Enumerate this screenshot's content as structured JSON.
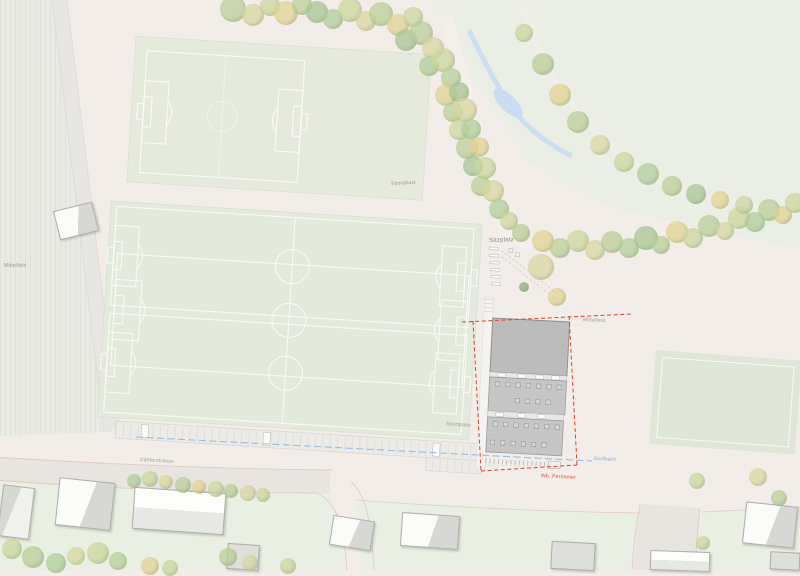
{
  "map": {
    "labels": {
      "sportplatz_top": "Sportplatz",
      "sitzplatz": "Sitzplatz",
      "mittelfeld_left": "Mittelfeld",
      "mittelfeld_right": "Mittelfeld",
      "sportplatz_bottom": "Sportplatz",
      "street": "Dählerstrasse",
      "perimeter": "Wb. Perimeter",
      "creek": "Dorfbach"
    },
    "colors": {
      "ground": "#f2ede9",
      "meadow": "#ebeee5",
      "lawn": "#e9efe2",
      "field_green": "#e3e9db",
      "pitch_line": "#ffffff",
      "roof_dark": "#bcbcbc",
      "roof_mid": "#c6c6c6",
      "street": "#e8e4e0",
      "curb": "#e1cac3",
      "perimeter_red": "#e0402f",
      "creek_blue": "#8fb9e6",
      "water": "#cadcf0"
    },
    "trees": {
      "palette": [
        "#bccf9b",
        "#ccd89f",
        "#a9c795",
        "#dad8a3",
        "#e3d494",
        "#b3cf9e",
        "#8faf7f"
      ],
      "items": [
        [
          233,
          9,
          13,
          0
        ],
        [
          253,
          15,
          11,
          3
        ],
        [
          270,
          6,
          10,
          1
        ],
        [
          286,
          13,
          12,
          4
        ],
        [
          302,
          5,
          10,
          0
        ],
        [
          317,
          12,
          11,
          2
        ],
        [
          333,
          19,
          10,
          5
        ],
        [
          350,
          10,
          12,
          1
        ],
        [
          366,
          21,
          10,
          3
        ],
        [
          381,
          14,
          12,
          0
        ],
        [
          398,
          25,
          11,
          4
        ],
        [
          413,
          17,
          10,
          1
        ],
        [
          406,
          40,
          11,
          2
        ],
        [
          421,
          33,
          12,
          0
        ],
        [
          433,
          48,
          11,
          3
        ],
        [
          429,
          66,
          10,
          5
        ],
        [
          443,
          60,
          12,
          1
        ],
        [
          451,
          78,
          10,
          0
        ],
        [
          446,
          95,
          11,
          4
        ],
        [
          459,
          92,
          10,
          2
        ],
        [
          453,
          112,
          10,
          0
        ],
        [
          465,
          110,
          12,
          3
        ],
        [
          459,
          130,
          10,
          1
        ],
        [
          471,
          129,
          10,
          5
        ],
        [
          467,
          148,
          11,
          0
        ],
        [
          479,
          147,
          10,
          4
        ],
        [
          473,
          166,
          10,
          2
        ],
        [
          485,
          168,
          11,
          1
        ],
        [
          481,
          186,
          10,
          0
        ],
        [
          493,
          191,
          11,
          3
        ],
        [
          499,
          209,
          10,
          5
        ],
        [
          509,
          221,
          9,
          1
        ],
        [
          521,
          233,
          9,
          0
        ],
        [
          543,
          241,
          11,
          4
        ],
        [
          560,
          248,
          10,
          0
        ],
        [
          578,
          241,
          11,
          1
        ],
        [
          595,
          250,
          10,
          3
        ],
        [
          612,
          242,
          11,
          0
        ],
        [
          629,
          248,
          10,
          5
        ],
        [
          646,
          238,
          12,
          2
        ],
        [
          661,
          245,
          9,
          0
        ],
        [
          677,
          232,
          11,
          4
        ],
        [
          693,
          238,
          10,
          1
        ],
        [
          709,
          226,
          11,
          0
        ],
        [
          725,
          231,
          9,
          3
        ],
        [
          739,
          218,
          11,
          1
        ],
        [
          755,
          222,
          10,
          5
        ],
        [
          769,
          210,
          11,
          0
        ],
        [
          783,
          215,
          9,
          4
        ],
        [
          795,
          203,
          10,
          1
        ],
        [
          524,
          33,
          9,
          1
        ],
        [
          543,
          64,
          11,
          0
        ],
        [
          560,
          95,
          11,
          4
        ],
        [
          578,
          122,
          11,
          0
        ],
        [
          600,
          145,
          10,
          3
        ],
        [
          624,
          162,
          10,
          1
        ],
        [
          648,
          174,
          11,
          5
        ],
        [
          672,
          186,
          10,
          0
        ],
        [
          696,
          194,
          10,
          2
        ],
        [
          720,
          200,
          9,
          4
        ],
        [
          744,
          205,
          9,
          1
        ],
        [
          541,
          267,
          13,
          3
        ],
        [
          557,
          297,
          9,
          4
        ],
        [
          524,
          287,
          5,
          6
        ],
        [
          134,
          481,
          7,
          5
        ],
        [
          150,
          479,
          8,
          1
        ],
        [
          166,
          482,
          7,
          3
        ],
        [
          183,
          485,
          8,
          0
        ],
        [
          199,
          487,
          7,
          4
        ],
        [
          216,
          489,
          8,
          1
        ],
        [
          231,
          491,
          7,
          0
        ],
        [
          248,
          493,
          8,
          3
        ],
        [
          263,
          495,
          7,
          1
        ],
        [
          12,
          549,
          10,
          1
        ],
        [
          33,
          557,
          11,
          0
        ],
        [
          56,
          563,
          10,
          5
        ],
        [
          76,
          556,
          9,
          3
        ],
        [
          98,
          553,
          11,
          1
        ],
        [
          118,
          561,
          9,
          0
        ],
        [
          150,
          566,
          9,
          4
        ],
        [
          170,
          568,
          8,
          1
        ],
        [
          228,
          557,
          9,
          0
        ],
        [
          250,
          563,
          8,
          3
        ],
        [
          288,
          566,
          8,
          1
        ],
        [
          697,
          481,
          8,
          1
        ],
        [
          758,
          477,
          9,
          3
        ],
        [
          779,
          498,
          8,
          0
        ],
        [
          703,
          543,
          7,
          1
        ]
      ]
    },
    "houses": [
      {
        "x": 56,
        "y": 206,
        "w": 38,
        "h": 28,
        "rot": -14,
        "v": "a"
      },
      {
        "x": 0,
        "y": 486,
        "w": 30,
        "h": 50,
        "rot": 7,
        "v": "b"
      },
      {
        "x": 57,
        "y": 480,
        "w": 54,
        "h": 46,
        "rot": 6,
        "v": "a"
      },
      {
        "x": 133,
        "y": 490,
        "w": 90,
        "h": 40,
        "rot": 4,
        "v": "r"
      },
      {
        "x": 227,
        "y": 544,
        "w": 30,
        "h": 24,
        "rot": 4,
        "v": "d"
      },
      {
        "x": 331,
        "y": 518,
        "w": 40,
        "h": 28,
        "rot": 9,
        "v": "a"
      },
      {
        "x": 401,
        "y": 514,
        "w": 56,
        "h": 32,
        "rot": 4,
        "v": "a"
      },
      {
        "x": 551,
        "y": 542,
        "w": 42,
        "h": 26,
        "rot": 3,
        "v": "d"
      },
      {
        "x": 650,
        "y": 551,
        "w": 58,
        "h": 18,
        "rot": 2,
        "v": "r"
      },
      {
        "x": 744,
        "y": 504,
        "w": 50,
        "h": 40,
        "rot": 6,
        "v": "a"
      },
      {
        "x": 770,
        "y": 552,
        "w": 28,
        "h": 16,
        "rot": 3,
        "v": "d"
      }
    ]
  }
}
